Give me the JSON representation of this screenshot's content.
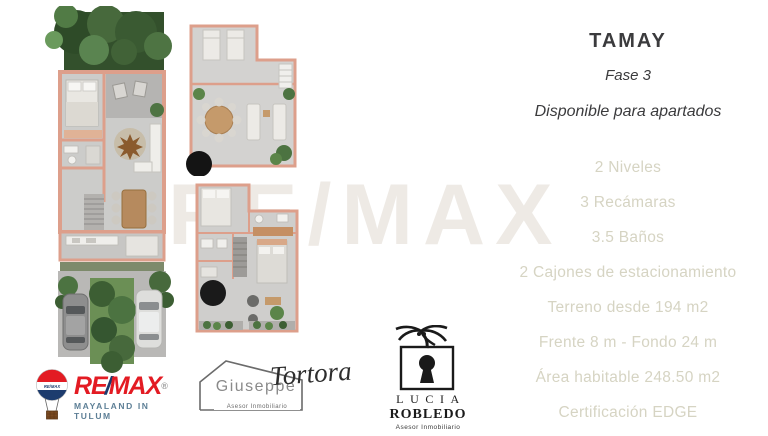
{
  "header": {
    "title": "TAMAY",
    "phase": "Fase 3",
    "availability": "Disponible para apartados"
  },
  "features": [
    "2 Niveles",
    "3 Recámaras",
    "3.5 Baños",
    "2 Cajones de estacionamiento",
    "Terreno desde 194 m2",
    "Frente 8 m - Fondo 24 m",
    "Área habitable 248.50 m2",
    "Certificación EDGE"
  ],
  "watermark": {
    "text": "RE/MAX"
  },
  "logos": {
    "remax": {
      "re": "RE",
      "slash": "/",
      "max": "MAX",
      "registered": "®",
      "balloon_label": "RE/MAX",
      "subtitle": "MAYALAND IN TULUM"
    },
    "giuseppe": {
      "first_name": "Giuseppe",
      "last_name": "Tortora",
      "subtitle": "Asesor Inmobiliario"
    },
    "lucia": {
      "first_name": "LUCIA",
      "last_name": "ROBLEDO",
      "subtitle": "Asesor Inmobiliario"
    }
  },
  "colors": {
    "wall_accent": "#dd9f8b",
    "feature_text": "#d6d4c3",
    "heading_text": "#3b3b3d",
    "remax_red": "#e31b23",
    "remax_blue": "#1d3c6e"
  }
}
